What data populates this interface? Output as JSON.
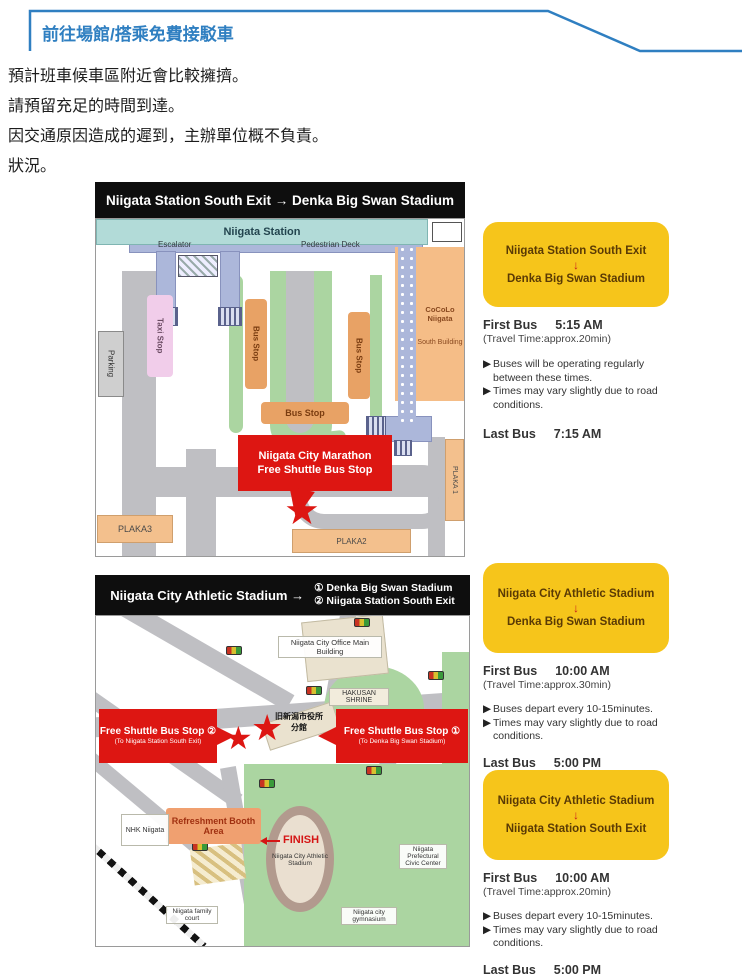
{
  "page": {
    "header_tab": "前往場館/搭乘免費接駁車",
    "paragraphs": [
      "預計班車候車區附近會比較擁擠。",
      "請預留充足的時間到達。",
      "因交通原因造成的遲到，主辦單位概不負責。",
      "狀況。"
    ]
  },
  "ui": {
    "bullet": "▶",
    "star": "★",
    "down_arrow": "↓"
  },
  "colors": {
    "accent_blue": "#2f7fc1",
    "panel_yellow": "#f6c51b",
    "alert_red": "#dd1612",
    "title_black": "#0e0e0e"
  },
  "map1": {
    "title": "Niigata Station South Exit  →  Denka Big Swan Stadium",
    "labels": {
      "station": "Niigata Station",
      "escalator": "Escalator",
      "pedestrian_deck": "Pedestrian Deck",
      "taxi_stop": "Taxi Stop",
      "bus_stop": "Bus Stop",
      "parking": "Parking",
      "cocolo_top": "CoCoLo Niigata",
      "cocolo_bottom": "South Building",
      "plaka1": "PLAKA 1",
      "plaka2": "PLAKA2",
      "plaka3": "PLAKA3",
      "callout_line1": "Niigata City Marathon",
      "callout_line2": "Free Shuttle Bus Stop"
    }
  },
  "panel1": {
    "from": "Niigata Station South Exit",
    "to": "Denka Big Swan Stadium",
    "first_label": "First Bus",
    "first_time": "5:15  AM",
    "travel": "(Travel Time:approx.20min)",
    "notes": [
      "Buses will be operating regularly between these times.",
      "Times may vary slightly due to road conditions."
    ],
    "last_label": "Last Bus",
    "last_time": "7:15  AM"
  },
  "map2": {
    "title_main": "Niigata City Athletic Stadium →",
    "title_opt1": "① Denka Big Swan Stadium",
    "title_opt2": "② Niigata Station South Exit",
    "labels": {
      "city_office": "Niigata City Office Main Building",
      "hakusan": "HAKUSAN SHRINE",
      "old_hall_1": "旧新潟市役所",
      "old_hall_2": "分館",
      "stop2": "Free Shuttle Bus Stop ②",
      "stop2_sub": "(To Niigata Station South Exit)",
      "stop1": "Free Shuttle Bus Stop ①",
      "stop1_sub": "(To Denka Big Swan Stadium)",
      "refreshment": "Refreshment Booth Area",
      "finish": "FINISH",
      "stadium": "Niigata City Athletic Stadium",
      "nhk": "NHK Niigata",
      "family_court": "Niigata family court",
      "civic_center": "Niigata Prefectural Civic Center",
      "gymnasium": "Niigata city gymnasium"
    }
  },
  "panel2": {
    "from": "Niigata City Athletic Stadium",
    "to": "Denka Big Swan Stadium",
    "first_label": "First Bus",
    "first_time": "10:00  AM",
    "travel": "(Travel Time:approx.30min)",
    "notes": [
      "Buses depart every 10-15minutes.",
      "Times may vary slightly due to road conditions."
    ],
    "last_label": "Last Bus",
    "last_time": "5:00  PM"
  },
  "panel3": {
    "from": "Niigata City Athletic Stadium",
    "to": "Niigata Station South Exit",
    "first_label": "First Bus",
    "first_time": "10:00  AM",
    "travel": "(Travel Time:approx.20min)",
    "notes": [
      "Buses depart every 10-15minutes.",
      "Times may vary slightly due to road conditions."
    ],
    "last_label": "Last Bus",
    "last_time": "5:00  PM"
  }
}
